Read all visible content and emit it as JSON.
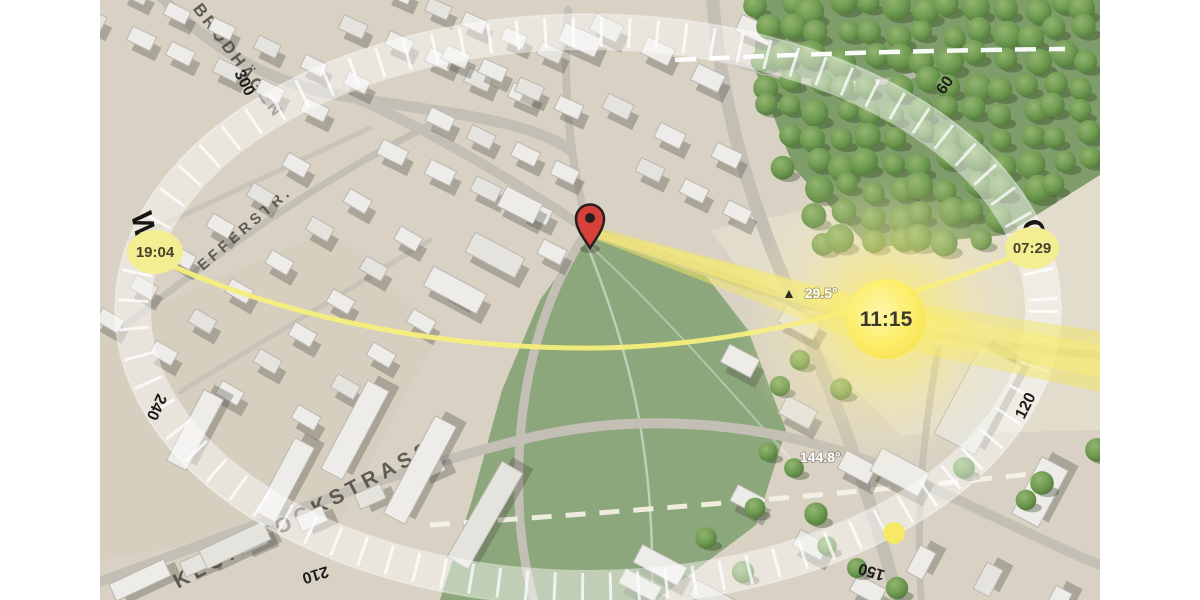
{
  "scene": {
    "current_time": "11:15",
    "sunrise_time": "07:29",
    "sunset_time": "19:04",
    "sun_elevation_icon": "▲",
    "sun_elevation": "29.5°",
    "sun_azimuth": "144.8°"
  },
  "compass": {
    "west": "W",
    "east": "O",
    "degrees": {
      "d300": "300",
      "d240": "240",
      "d210": "210",
      "d150": "150",
      "d120": "120",
      "d60": "60"
    }
  },
  "streets": {
    "brodhaegen": "AM BRODHÄGEN",
    "efferstr": "EFFERSTR.",
    "klopstock": "KLOPSTOCKSTRASSE"
  },
  "colors": {
    "ground": "#d9d2c4",
    "field_green": "#8ca77b",
    "forest_green": "#7e9d6b",
    "tree_green": "#6f9b52",
    "sun_yellow": "#fdee6d",
    "sun_path_yellow": "#f6ee7c",
    "time_bubble_yellow": "#f3ee92",
    "pin_red": "#d8413a",
    "compass_band": "rgba(255,255,255,0.5)"
  }
}
